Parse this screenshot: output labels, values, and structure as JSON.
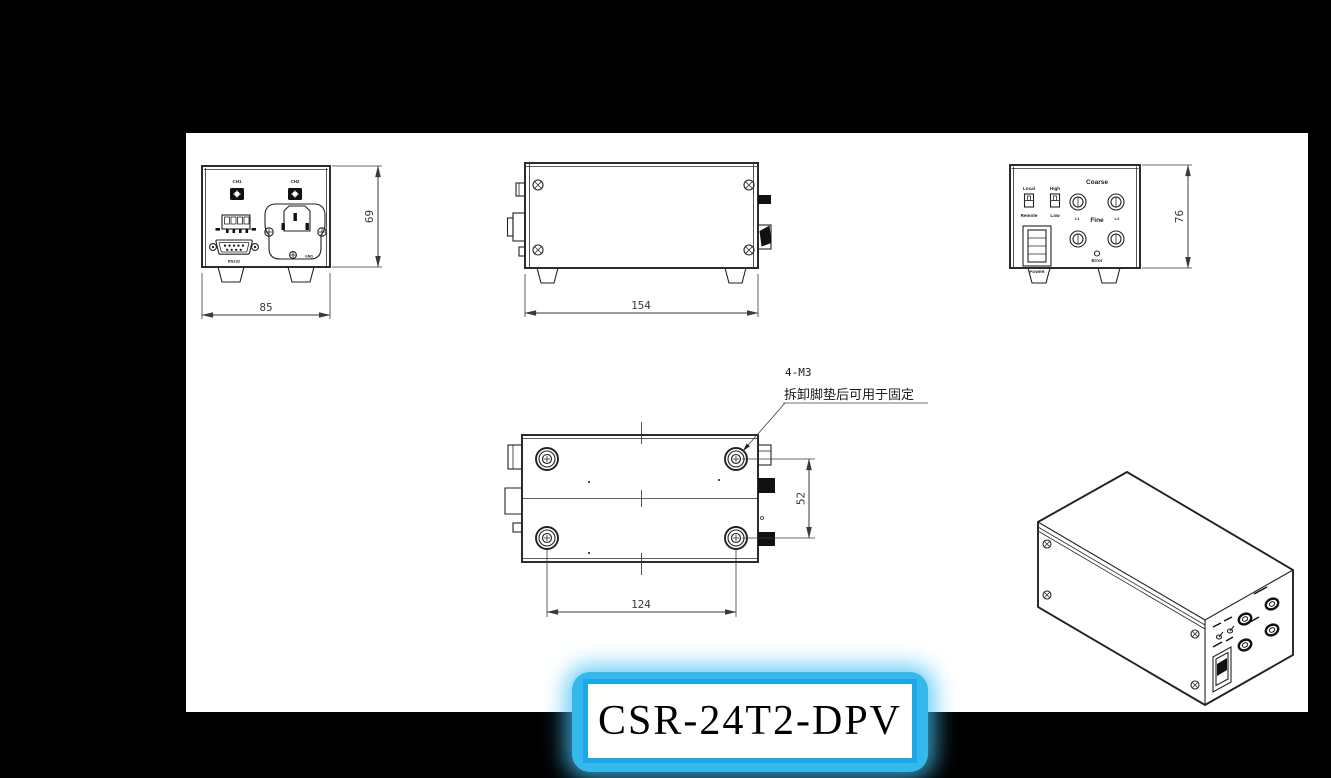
{
  "colors": {
    "background": "#000000",
    "paper": "#ffffff",
    "accent_cyan": "#29b4e8",
    "line": "#222222"
  },
  "title_box": {
    "model": "CSR-24T2-DPV"
  },
  "rear_view": {
    "ch1": "CH1",
    "ch2": "CH2",
    "rs232": "RS232",
    "gnd": "GND",
    "dim_width": "85",
    "dim_height": "69"
  },
  "side_view": {
    "dim_length": "154"
  },
  "front_view": {
    "local": "Local",
    "high": "High",
    "remote": "Remote",
    "low": "Low",
    "coarse": "Coarse",
    "fine": "Fine",
    "l1": "L1",
    "l2": "L2",
    "power": "POWER",
    "error": "Error",
    "dim_height": "76"
  },
  "bottom_view": {
    "callout_line1": "4-M3",
    "callout_line2": "拆卸脚垫后可用于固定",
    "dim_span_x": "124",
    "dim_span_y": "52"
  }
}
